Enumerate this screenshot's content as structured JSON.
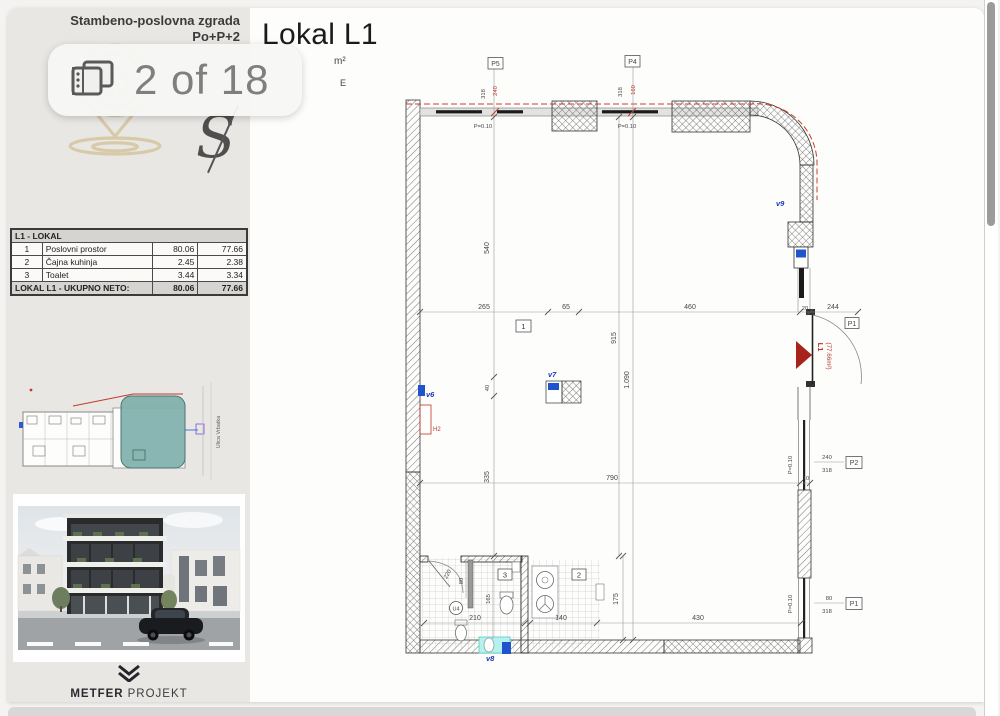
{
  "viewer": {
    "badge_label": "2 of 18",
    "page_title": "Lokal L1",
    "subtitle_fragment_1": "m²",
    "subtitle_fragment_2": "E"
  },
  "sidebar": {
    "header_line1": "Stambeno-poslovna zgrada",
    "header_line2": "Po+P+2",
    "watermark_letter": "S",
    "area_table": {
      "title": "L1 - LOKAL",
      "rows": [
        {
          "num": "1",
          "name": "Poslovni prostor",
          "bruto": "80.06",
          "neto": "77.66"
        },
        {
          "num": "2",
          "name": "Čajna kuhinja",
          "bruto": "2.45",
          "neto": "2.38"
        },
        {
          "num": "3",
          "name": "Toalet",
          "bruto": "3.44",
          "neto": "3.34"
        }
      ],
      "total_label": "LOKAL L1 - UKUPNO NETO:",
      "total_bruto": "80.06",
      "total_neto": "77.66"
    },
    "overview_street_label": "Ulica Vrbatka",
    "logo_bold": "METFER",
    "logo_light": "PROJEKT"
  },
  "plan": {
    "axes": {
      "p5": "P5",
      "p4": "P4",
      "p2": "P2",
      "p1": "P1",
      "p1_door": "P1"
    },
    "windows": {
      "p5_h": "318",
      "p5_w": "240",
      "p4_h": "318",
      "p4_w": "160",
      "p2_w": "240",
      "p2_h": "318",
      "p1_w": "80",
      "p1_h": "318"
    },
    "parapet": "P=0.10",
    "dims": {
      "d540": "540",
      "d265": "265",
      "d65": "65",
      "d460": "460",
      "d20": "20",
      "d244": "244",
      "d915": "915",
      "d1090": "1.090",
      "d40": "40",
      "d335": "335",
      "d790": "790",
      "d10": "10",
      "d210": "210",
      "d140": "140",
      "d430": "430",
      "d175": "175",
      "d165": "165",
      "d80": "80",
      "d220": "220"
    },
    "rooms": {
      "r1": "1",
      "r2": "2",
      "r3": "3"
    },
    "vents": {
      "v6": "v6",
      "v7": "v7",
      "v8": "v8",
      "v9": "v9"
    },
    "h2": "H2",
    "entrance_label": "L1",
    "entrance_area": "(77.66m²)",
    "u4": "U4",
    "colors": {
      "dim_red": "#bb3328",
      "vent_blue": "#1838b8",
      "highlight_teal": "#7fb0ab",
      "watermark_gold": "#d5c69e",
      "cyan_marker": "#b5f2ef"
    }
  }
}
